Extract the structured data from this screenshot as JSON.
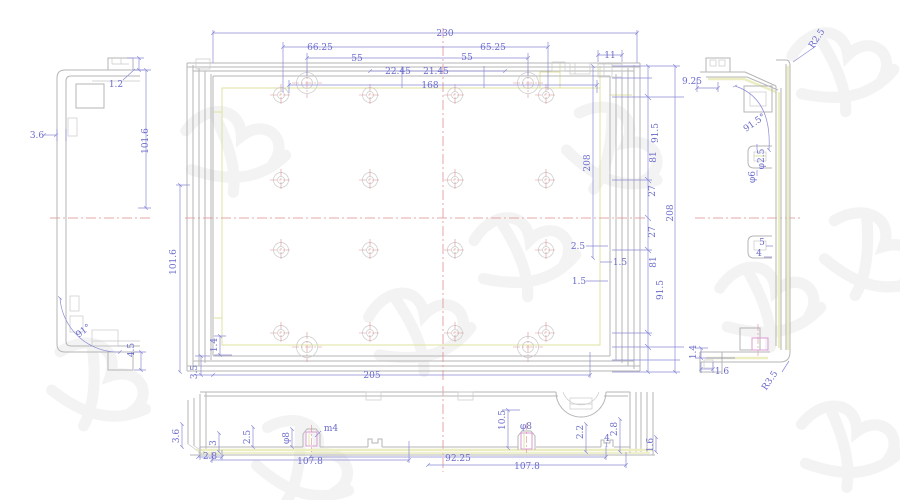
{
  "colors": {
    "geometry": "#b6b6b6",
    "dimension": "#8a8ad6",
    "dimension_text": "#6a6acc",
    "accent_khaki": "#dce09c",
    "centerline_red": "#e08f8f",
    "highlight_pink": "#db9bd4",
    "watermark": "#ededed",
    "background": "#ffffff"
  },
  "labels": [
    {
      "text": "230",
      "x": 445,
      "y": 36,
      "r": 0
    },
    {
      "text": "66.25",
      "x": 320,
      "y": 50,
      "r": 0
    },
    {
      "text": "65.25",
      "x": 493,
      "y": 50,
      "r": 0
    },
    {
      "text": "55",
      "x": 357,
      "y": 61,
      "r": 0
    },
    {
      "text": "55",
      "x": 467,
      "y": 60,
      "r": 0
    },
    {
      "text": "22.45",
      "x": 398,
      "y": 74,
      "r": 0
    },
    {
      "text": "21.45",
      "x": 436,
      "y": 74,
      "r": 0
    },
    {
      "text": "168",
      "x": 430,
      "y": 88,
      "r": 0
    },
    {
      "text": "11",
      "x": 610,
      "y": 58,
      "r": 0
    },
    {
      "text": "101.6",
      "x": 176,
      "y": 262,
      "r": -90
    },
    {
      "text": "1.4",
      "x": 217,
      "y": 345,
      "r": -90
    },
    {
      "text": "3.5",
      "x": 197,
      "y": 372,
      "r": -90
    },
    {
      "text": "205",
      "x": 372,
      "y": 378,
      "r": 0
    },
    {
      "text": "208",
      "x": 590,
      "y": 163,
      "r": -90
    },
    {
      "text": "91.5",
      "x": 658,
      "y": 133,
      "r": -90
    },
    {
      "text": "81",
      "x": 656,
      "y": 157,
      "r": -90
    },
    {
      "text": "27",
      "x": 655,
      "y": 191,
      "r": -90
    },
    {
      "text": "208",
      "x": 673,
      "y": 213,
      "r": -90
    },
    {
      "text": "27",
      "x": 655,
      "y": 232,
      "r": -90
    },
    {
      "text": "81",
      "x": 656,
      "y": 262,
      "r": -90
    },
    {
      "text": "91.5",
      "x": 663,
      "y": 290,
      "r": -90
    },
    {
      "text": "2.5",
      "x": 578,
      "y": 249,
      "r": 0
    },
    {
      "text": "1.5",
      "x": 620,
      "y": 265,
      "r": 0
    },
    {
      "text": "1.5",
      "x": 579,
      "y": 284,
      "r": 0
    },
    {
      "text": "3.6",
      "x": 37,
      "y": 138,
      "r": 0
    },
    {
      "text": "1.2",
      "x": 116,
      "y": 87,
      "r": 0
    },
    {
      "text": "101.6",
      "x": 148,
      "y": 141,
      "r": -90
    },
    {
      "text": "91°",
      "x": 85,
      "y": 333,
      "r": -38
    },
    {
      "text": "4.5",
      "x": 134,
      "y": 350,
      "r": -90
    },
    {
      "text": "9.25",
      "x": 692,
      "y": 84,
      "r": 0
    },
    {
      "text": "R2.5",
      "x": 819,
      "y": 40,
      "r": -56
    },
    {
      "text": "91.5°",
      "x": 756,
      "y": 125,
      "r": -35
    },
    {
      "text": "φ2.5",
      "x": 764,
      "y": 159,
      "r": -90
    },
    {
      "text": "φ6",
      "x": 755,
      "y": 177,
      "r": -90
    },
    {
      "text": "5",
      "x": 762,
      "y": 245,
      "r": 0
    },
    {
      "text": "4",
      "x": 759,
      "y": 256,
      "r": 0
    },
    {
      "text": "1.4",
      "x": 696,
      "y": 352,
      "r": -90
    },
    {
      "text": "1.6",
      "x": 722,
      "y": 374,
      "r": 0
    },
    {
      "text": "R3.5",
      "x": 772,
      "y": 382,
      "r": -56
    },
    {
      "text": "3.6",
      "x": 179,
      "y": 436,
      "r": -90
    },
    {
      "text": "3",
      "x": 216,
      "y": 443,
      "r": -90
    },
    {
      "text": "2.5",
      "x": 250,
      "y": 437,
      "r": -90
    },
    {
      "text": "φ8",
      "x": 289,
      "y": 438,
      "r": -90
    },
    {
      "text": "m4",
      "x": 331,
      "y": 431,
      "r": 0
    },
    {
      "text": "2.8",
      "x": 210,
      "y": 459,
      "r": 0
    },
    {
      "text": "107.8",
      "x": 310,
      "y": 464,
      "r": 0
    },
    {
      "text": "10.5",
      "x": 505,
      "y": 420,
      "r": -90
    },
    {
      "text": "φ8",
      "x": 526,
      "y": 429,
      "r": 0
    },
    {
      "text": "2.2",
      "x": 583,
      "y": 432,
      "r": -90
    },
    {
      "text": "4",
      "x": 607,
      "y": 441,
      "r": 0
    },
    {
      "text": "2.8",
      "x": 617,
      "y": 429,
      "r": -90
    },
    {
      "text": "1.6",
      "x": 653,
      "y": 445,
      "r": -90
    },
    {
      "text": "92.25",
      "x": 458,
      "y": 461,
      "r": 0
    },
    {
      "text": "107.8",
      "x": 527,
      "y": 469,
      "r": 0
    }
  ],
  "holes": {
    "small_cols": [
      281,
      370,
      455,
      546
    ],
    "small_rows": [
      95,
      180,
      250,
      333
    ],
    "small_outer_r": 7.5,
    "small_inner_r": 3.5,
    "large": [
      [
        307,
        83
      ],
      [
        528,
        83
      ],
      [
        307,
        347
      ],
      [
        528,
        347
      ]
    ],
    "large_outer_r": 10.5,
    "large_inner_r": 5.5
  },
  "watermarks": [
    [
      838,
      70,
      -18
    ],
    [
      868,
      255,
      10
    ],
    [
      765,
      305,
      -15
    ],
    [
      845,
      445,
      -10
    ],
    [
      300,
      463,
      12
    ],
    [
      415,
      330,
      -20
    ],
    [
      610,
      150,
      15
    ],
    [
      230,
      150,
      -12
    ],
    [
      95,
      385,
      8
    ],
    [
      520,
      255,
      -18
    ]
  ]
}
